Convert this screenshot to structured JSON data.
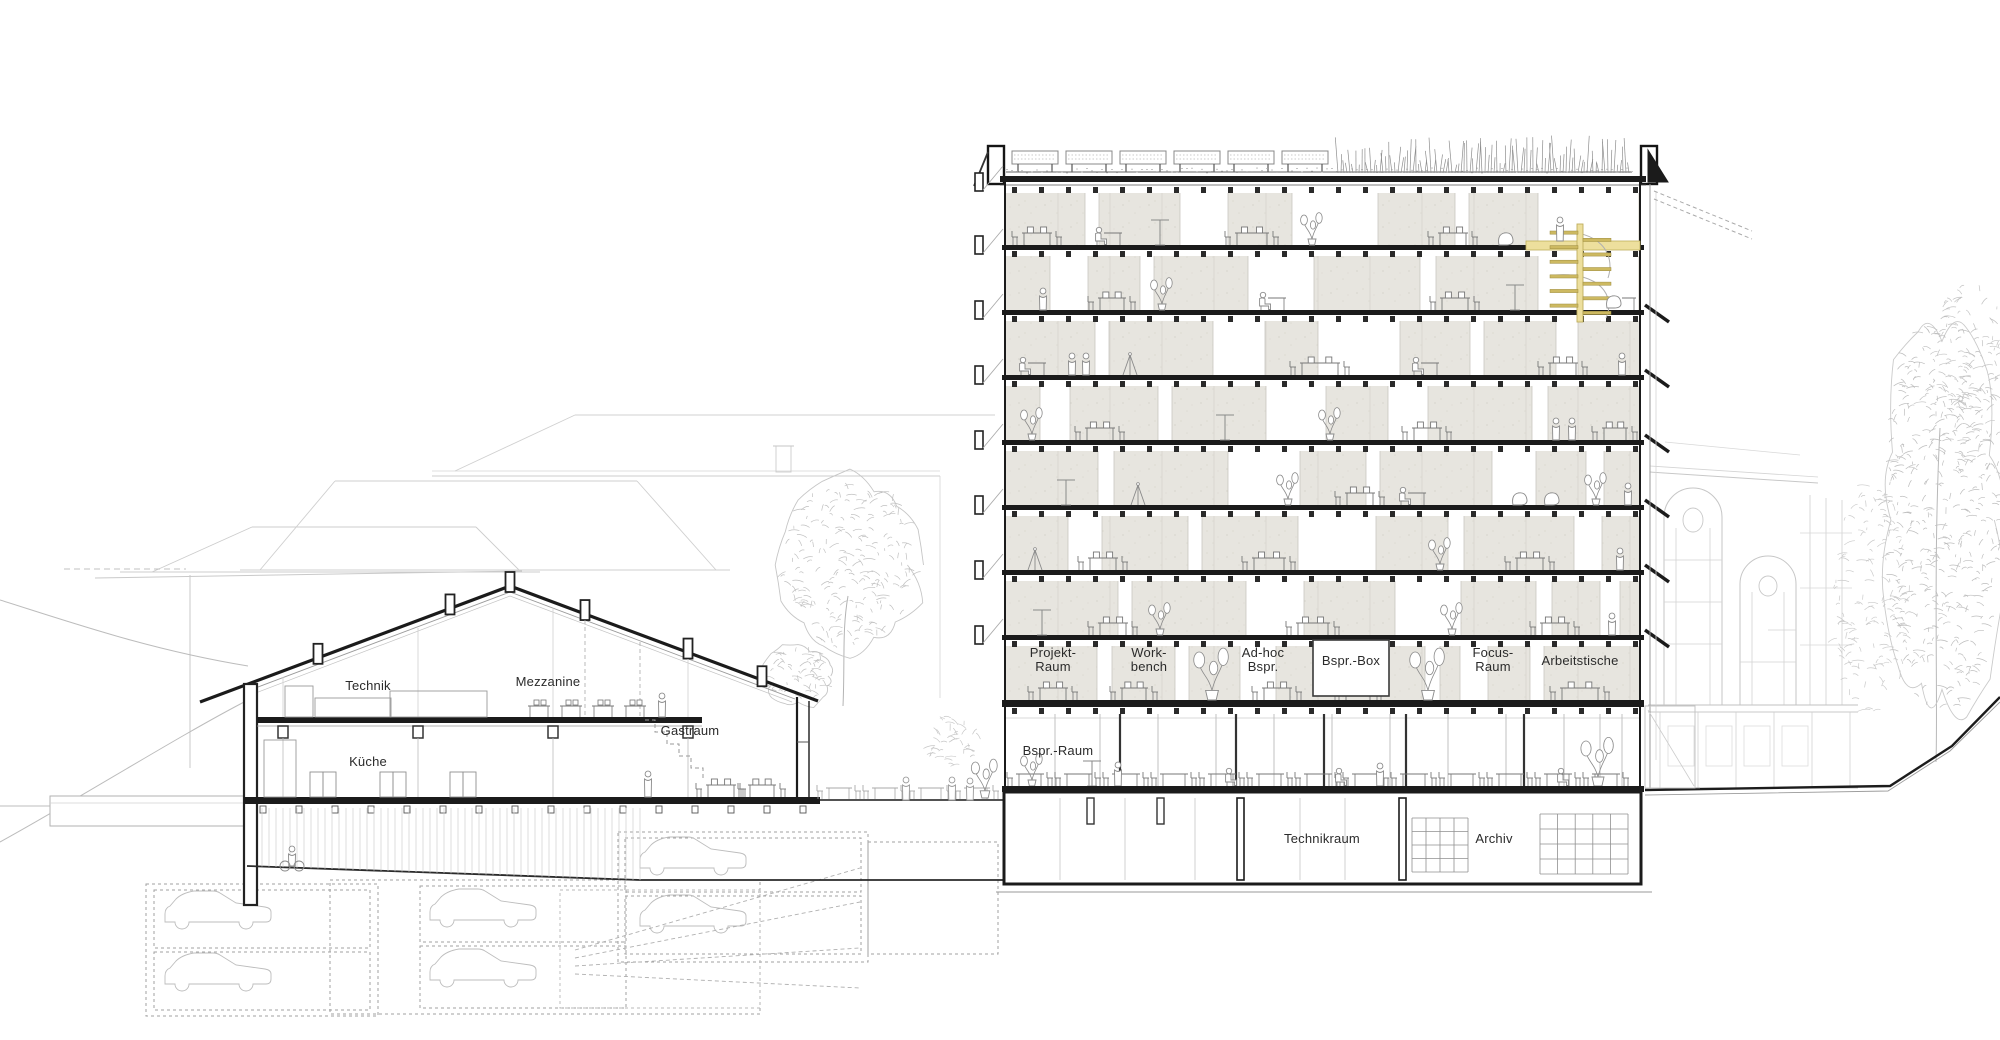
{
  "drawing": {
    "type": "architectural-building-section",
    "labels": {
      "technik": "Technik",
      "mezzanine": "Mezzanine",
      "kueche": "Küche",
      "gastraum": "Gastraum",
      "bspr_raum": "Bspr.-Raum",
      "technikraum": "Technikraum",
      "archiv": "Archiv"
    },
    "program_rooms": [
      {
        "line1": "Projekt-",
        "line2": "Raum"
      },
      {
        "line1": "Work-",
        "line2": "bench"
      },
      {
        "line1": "Ad-hoc",
        "line2": "Bspr."
      },
      {
        "line1": "Bspr.-Box",
        "line2": ""
      },
      {
        "line1": "Focus-",
        "line2": "Raum"
      },
      {
        "line1": "Arbeitstische",
        "line2": ""
      }
    ],
    "colors": {
      "accent_yellow": "#eddf9d",
      "accent_yellow_dark": "#bfae5c",
      "concrete": "#e7e5df",
      "ink": "#1c1c1c"
    }
  }
}
